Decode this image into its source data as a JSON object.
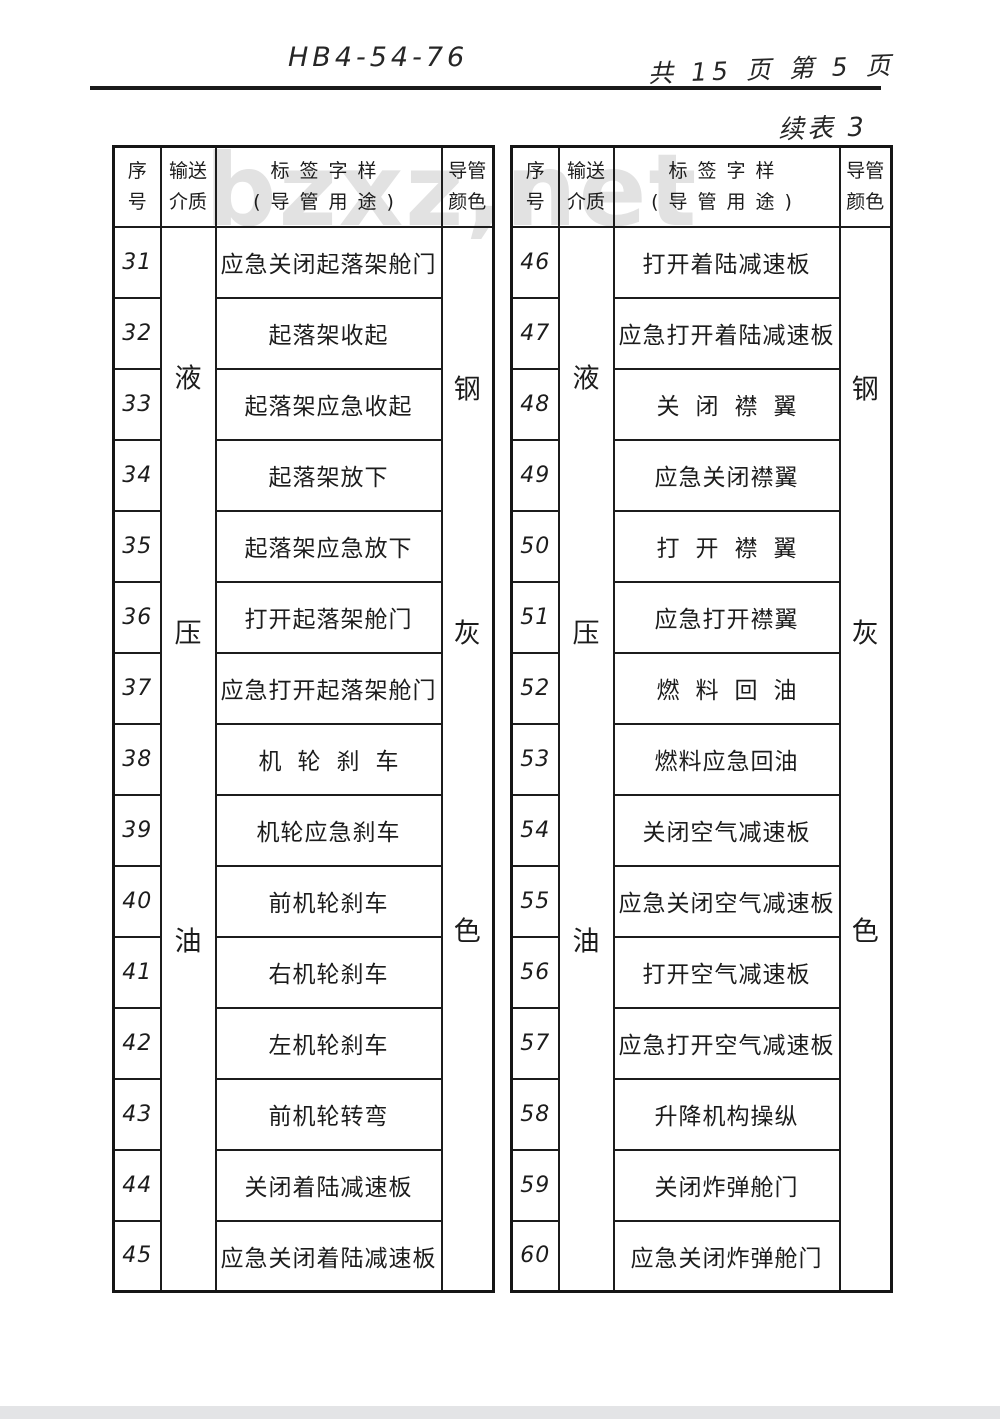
{
  "page": {
    "doc_number": "HB4-54-76",
    "page_info": "共 15 页 第 5 页",
    "continuation_label": "续表 3",
    "watermark": "bzxz,net"
  },
  "colors": {
    "paper": "#ffffff",
    "ink": "#1c1c1c",
    "table_border": "#151515",
    "watermark": "#e2e2e2",
    "bottom_scan_strip": "#e3e4e6"
  },
  "table_header": {
    "serial_line1": "序",
    "serial_line2": "号",
    "medium_line1": "输送",
    "medium_line2": "介质",
    "label_line1": "标签字样",
    "label_line2": "(导管用途)",
    "color_line1": "导管",
    "color_line2": "颜色"
  },
  "left_table": {
    "medium_chars": [
      "液",
      "压",
      "油"
    ],
    "color_chars": [
      "钢",
      "灰",
      "色"
    ],
    "rows": [
      {
        "no": "31",
        "label": "应急关闭起落架舱门"
      },
      {
        "no": "32",
        "label": "起落架收起"
      },
      {
        "no": "33",
        "label": "起落架应急收起"
      },
      {
        "no": "34",
        "label": "起落架放下"
      },
      {
        "no": "35",
        "label": "起落架应急放下"
      },
      {
        "no": "36",
        "label": "打开起落架舱门"
      },
      {
        "no": "37",
        "label": "应急打开起落架舱门"
      },
      {
        "no": "38",
        "label": "机轮刹车"
      },
      {
        "no": "39",
        "label": "机轮应急刹车"
      },
      {
        "no": "40",
        "label": "前机轮刹车"
      },
      {
        "no": "41",
        "label": "右机轮刹车"
      },
      {
        "no": "42",
        "label": "左机轮刹车"
      },
      {
        "no": "43",
        "label": "前机轮转弯"
      },
      {
        "no": "44",
        "label": "关闭着陆减速板"
      },
      {
        "no": "45",
        "label": "应急关闭着陆减速板"
      }
    ]
  },
  "right_table": {
    "medium_chars": [
      "液",
      "压",
      "油"
    ],
    "color_chars": [
      "钢",
      "灰",
      "色"
    ],
    "rows": [
      {
        "no": "46",
        "label": "打开着陆减速板"
      },
      {
        "no": "47",
        "label": "应急打开着陆减速板"
      },
      {
        "no": "48",
        "label": "关闭襟翼"
      },
      {
        "no": "49",
        "label": "应急关闭襟翼"
      },
      {
        "no": "50",
        "label": "打开襟翼"
      },
      {
        "no": "51",
        "label": "应急打开襟翼"
      },
      {
        "no": "52",
        "label": "燃料回油"
      },
      {
        "no": "53",
        "label": "燃料应急回油"
      },
      {
        "no": "54",
        "label": "关闭空气减速板"
      },
      {
        "no": "55",
        "label": "应急关闭空气减速板"
      },
      {
        "no": "56",
        "label": "打开空气减速板"
      },
      {
        "no": "57",
        "label": "应急打开空气减速板"
      },
      {
        "no": "58",
        "label": "升降机构操纵"
      },
      {
        "no": "59",
        "label": "关闭炸弹舱门"
      },
      {
        "no": "60",
        "label": "应急关闭炸弹舱门"
      }
    ]
  }
}
